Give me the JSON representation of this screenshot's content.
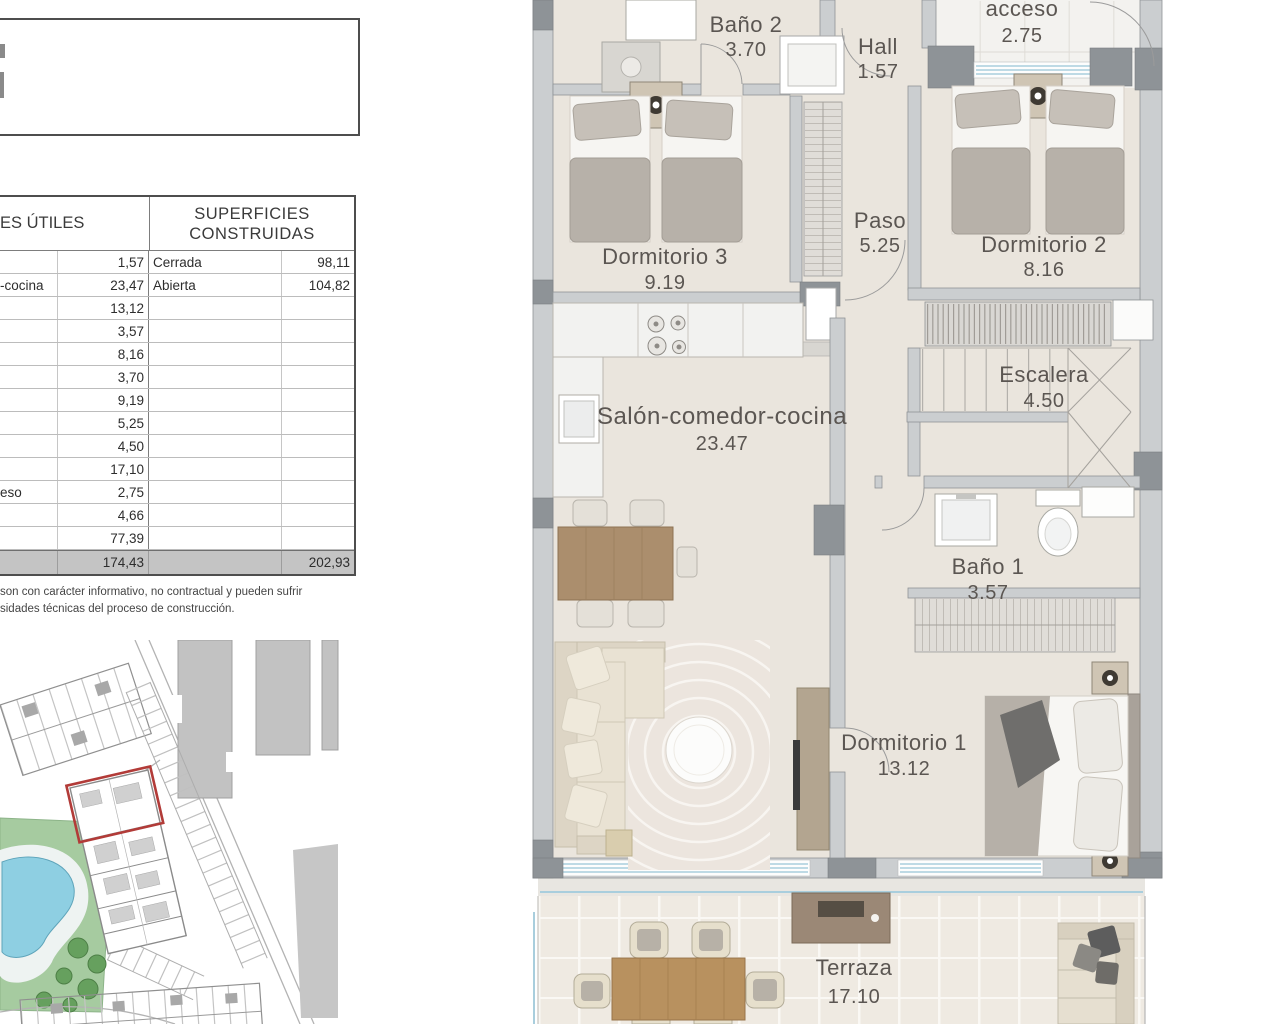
{
  "table": {
    "header_left": "ES ÚTILES",
    "header_right_line1": "SUPERFICIES",
    "header_right_line2": "CONSTRUIDAS",
    "rows": [
      {
        "label": "",
        "value": "1,57",
        "c_label": "Cerrada",
        "c_value": "98,11"
      },
      {
        "label": "-cocina",
        "value": "23,47",
        "c_label": "Abierta",
        "c_value": "104,82"
      },
      {
        "label": "",
        "value": "13,12",
        "c_label": "",
        "c_value": ""
      },
      {
        "label": "",
        "value": "3,57",
        "c_label": "",
        "c_value": ""
      },
      {
        "label": "",
        "value": "8,16",
        "c_label": "",
        "c_value": ""
      },
      {
        "label": "",
        "value": "3,70",
        "c_label": "",
        "c_value": ""
      },
      {
        "label": "",
        "value": "9,19",
        "c_label": "",
        "c_value": ""
      },
      {
        "label": "",
        "value": "5,25",
        "c_label": "",
        "c_value": ""
      },
      {
        "label": "",
        "value": "4,50",
        "c_label": "",
        "c_value": ""
      },
      {
        "label": "",
        "value": "17,10",
        "c_label": "",
        "c_value": ""
      },
      {
        "label": "eso",
        "value": "2,75",
        "c_label": "",
        "c_value": ""
      },
      {
        "label": "",
        "value": "4,66",
        "c_label": "",
        "c_value": ""
      },
      {
        "label": "",
        "value": "77,39",
        "c_label": "",
        "c_value": ""
      }
    ],
    "total": {
      "value": "174,43",
      "c_value": "202,93"
    },
    "disclaimer_line1": "son con carácter informativo, no contractual y pueden sufrir",
    "disclaimer_line2": "sidades técnicas del proceso de construcción."
  },
  "floorplan": {
    "rooms": [
      {
        "name": "Baño 2",
        "area": "3.70"
      },
      {
        "name": "Hall",
        "area": "1.57"
      },
      {
        "name": "acceso",
        "area": "2.75"
      },
      {
        "name": "Dormitorio 3",
        "area": "9.19"
      },
      {
        "name": "Dormitorio 2",
        "area": "8.16"
      },
      {
        "name": "Paso",
        "area": "5.25"
      },
      {
        "name": "Salón-comedor-cocina",
        "area": "23.47"
      },
      {
        "name": "Escalera",
        "area": "4.50"
      },
      {
        "name": "Baño 1",
        "area": "3.57"
      },
      {
        "name": "Dormitorio 1",
        "area": "13.12"
      },
      {
        "name": "Terraza",
        "area": "17.10"
      }
    ]
  },
  "colors": {
    "floor_beige": "#eae5dd",
    "terrace_beige": "#efeae2",
    "wall_gray": "#cbced0",
    "wall_dark": "#8e9397",
    "window_blue": "#a9cedd",
    "pool_blue": "#8ecfe2",
    "lawn_green": "#a6cba0",
    "highlight_red": "#b23b38",
    "total_row_gray": "#c4c4c4",
    "wood_tan": "#b8915f"
  }
}
